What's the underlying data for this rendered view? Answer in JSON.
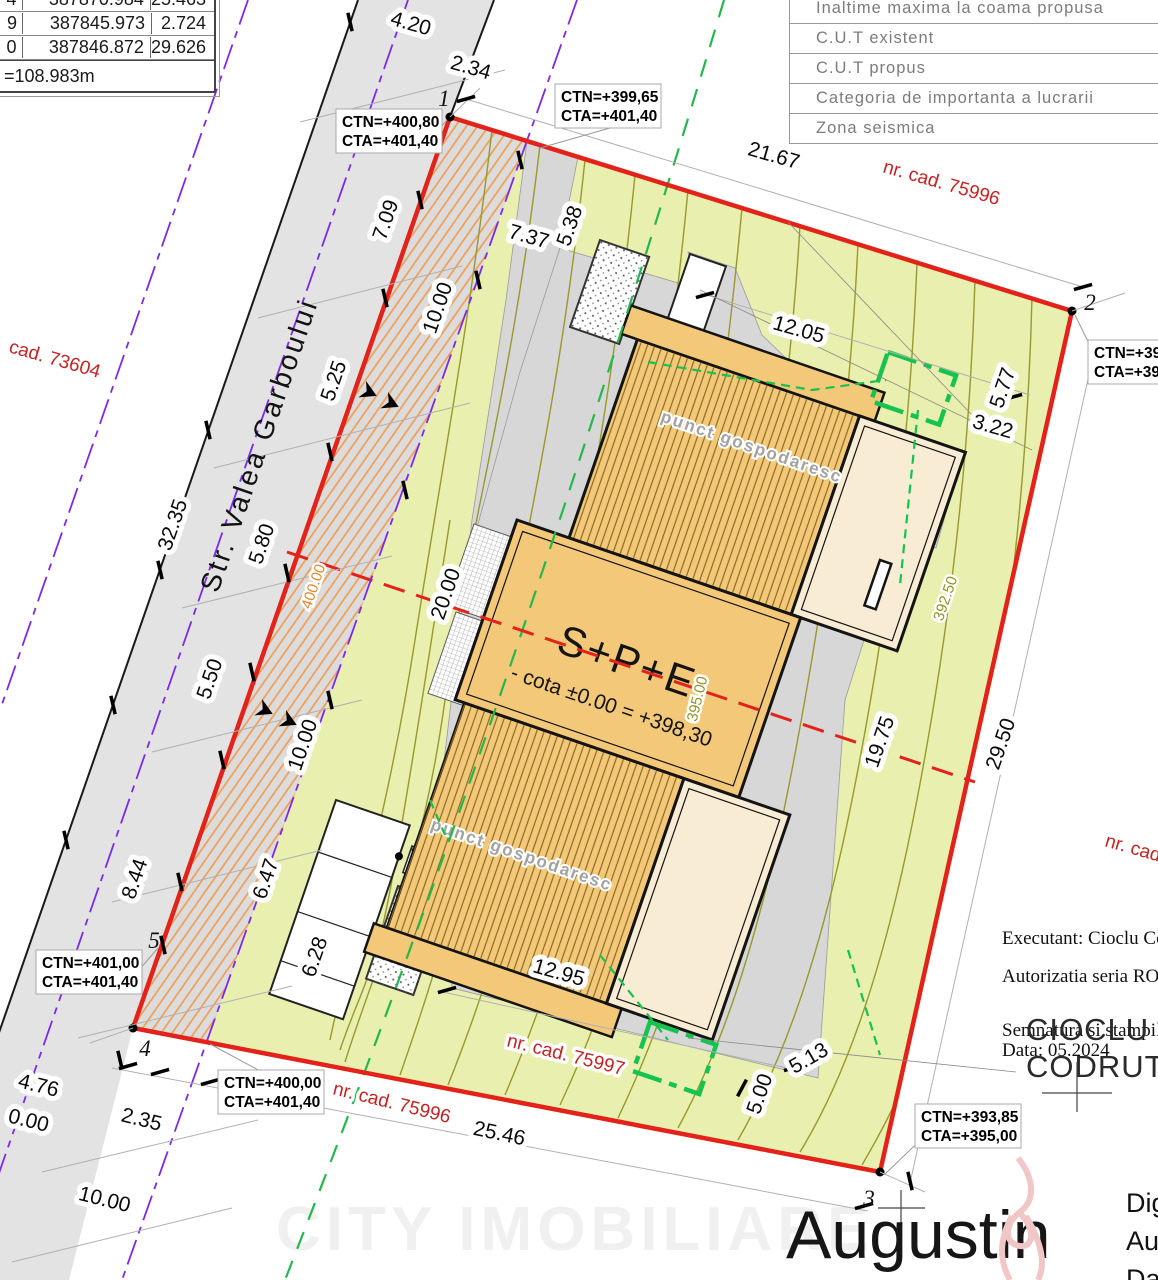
{
  "tables": {
    "coords": {
      "rows": [
        {
          "n": "4",
          "x": "387870.984",
          "d": "25.463"
        },
        {
          "n": "9",
          "x": "387845.973",
          "d": "2.724"
        },
        {
          "n": "0",
          "x": "387846.872",
          "d": "29.626"
        }
      ],
      "total": "=108.983m"
    },
    "params": {
      "rows": [
        "Inaltime maxima la coama propusa",
        "C.U.T existent",
        "C.U.T propus",
        "Categoria de importanta a lucrarii",
        "Zona seismica"
      ]
    }
  },
  "street": {
    "name": "Str. Valea Garboului"
  },
  "points": {
    "p1": "1",
    "p2": "2",
    "p3": "3",
    "p4": "4",
    "p5": "5"
  },
  "cadastral": {
    "left": "cad. 73604",
    "top": "nr. cad. 75996",
    "bottom": "nr. cad. 75996",
    "inner": "nr. cad. 75997",
    "right": "nr. cad"
  },
  "building": {
    "label": "S+P+E",
    "cota": "- cota ±0.00 = +398,30",
    "annex_upper": "punct gospodaresc",
    "annex_lower": "punct gospodaresc"
  },
  "contours": {
    "c400": "400.00",
    "c395": "395.00",
    "c392": "392.50"
  },
  "levels": [
    {
      "l1": "CTN=+400,80",
      "l2": "CTA=+401,40"
    },
    {
      "l1": "CTN=+399,65",
      "l2": "CTA=+401,40"
    },
    {
      "l1": "CTN=+391",
      "l2": "CTA=+393"
    },
    {
      "l1": "CTN=+401,00",
      "l2": "CTA=+401,40"
    },
    {
      "l1": "CTN=+400,00",
      "l2": "CTA=+401,40"
    },
    {
      "l1": "CTN=+393,85",
      "l2": "CTA=+395,00"
    }
  ],
  "dims": [
    "4.20",
    "2.34",
    "21.67",
    "7.09",
    "7.37",
    "5.38",
    "10.00",
    "5.25",
    "12.05",
    "5.77",
    "3.22",
    "32.35",
    "5.80",
    "20.00",
    "5.50",
    "10.00",
    "19.75",
    "29.50",
    "8.44",
    "6.47",
    "6.28",
    "12.95",
    "5.13",
    "5.00",
    "4.76",
    "0.00",
    "2.35",
    "10.00",
    "25.46"
  ],
  "signing": {
    "executant": "Executant: Cioclu Codru",
    "authorization": "Autorizatia seria RO-MM-",
    "signature_label": "Semnatura si stampila",
    "date": "Data: 05.2024",
    "stamp_line1": "CIOCLU",
    "stamp_line2": "CODRUT-R",
    "signer_name": "Augustin",
    "digital_lines": [
      "Digi",
      "Aug",
      "Dat"
    ]
  },
  "watermark": "CITY IMOBILIARE"
}
